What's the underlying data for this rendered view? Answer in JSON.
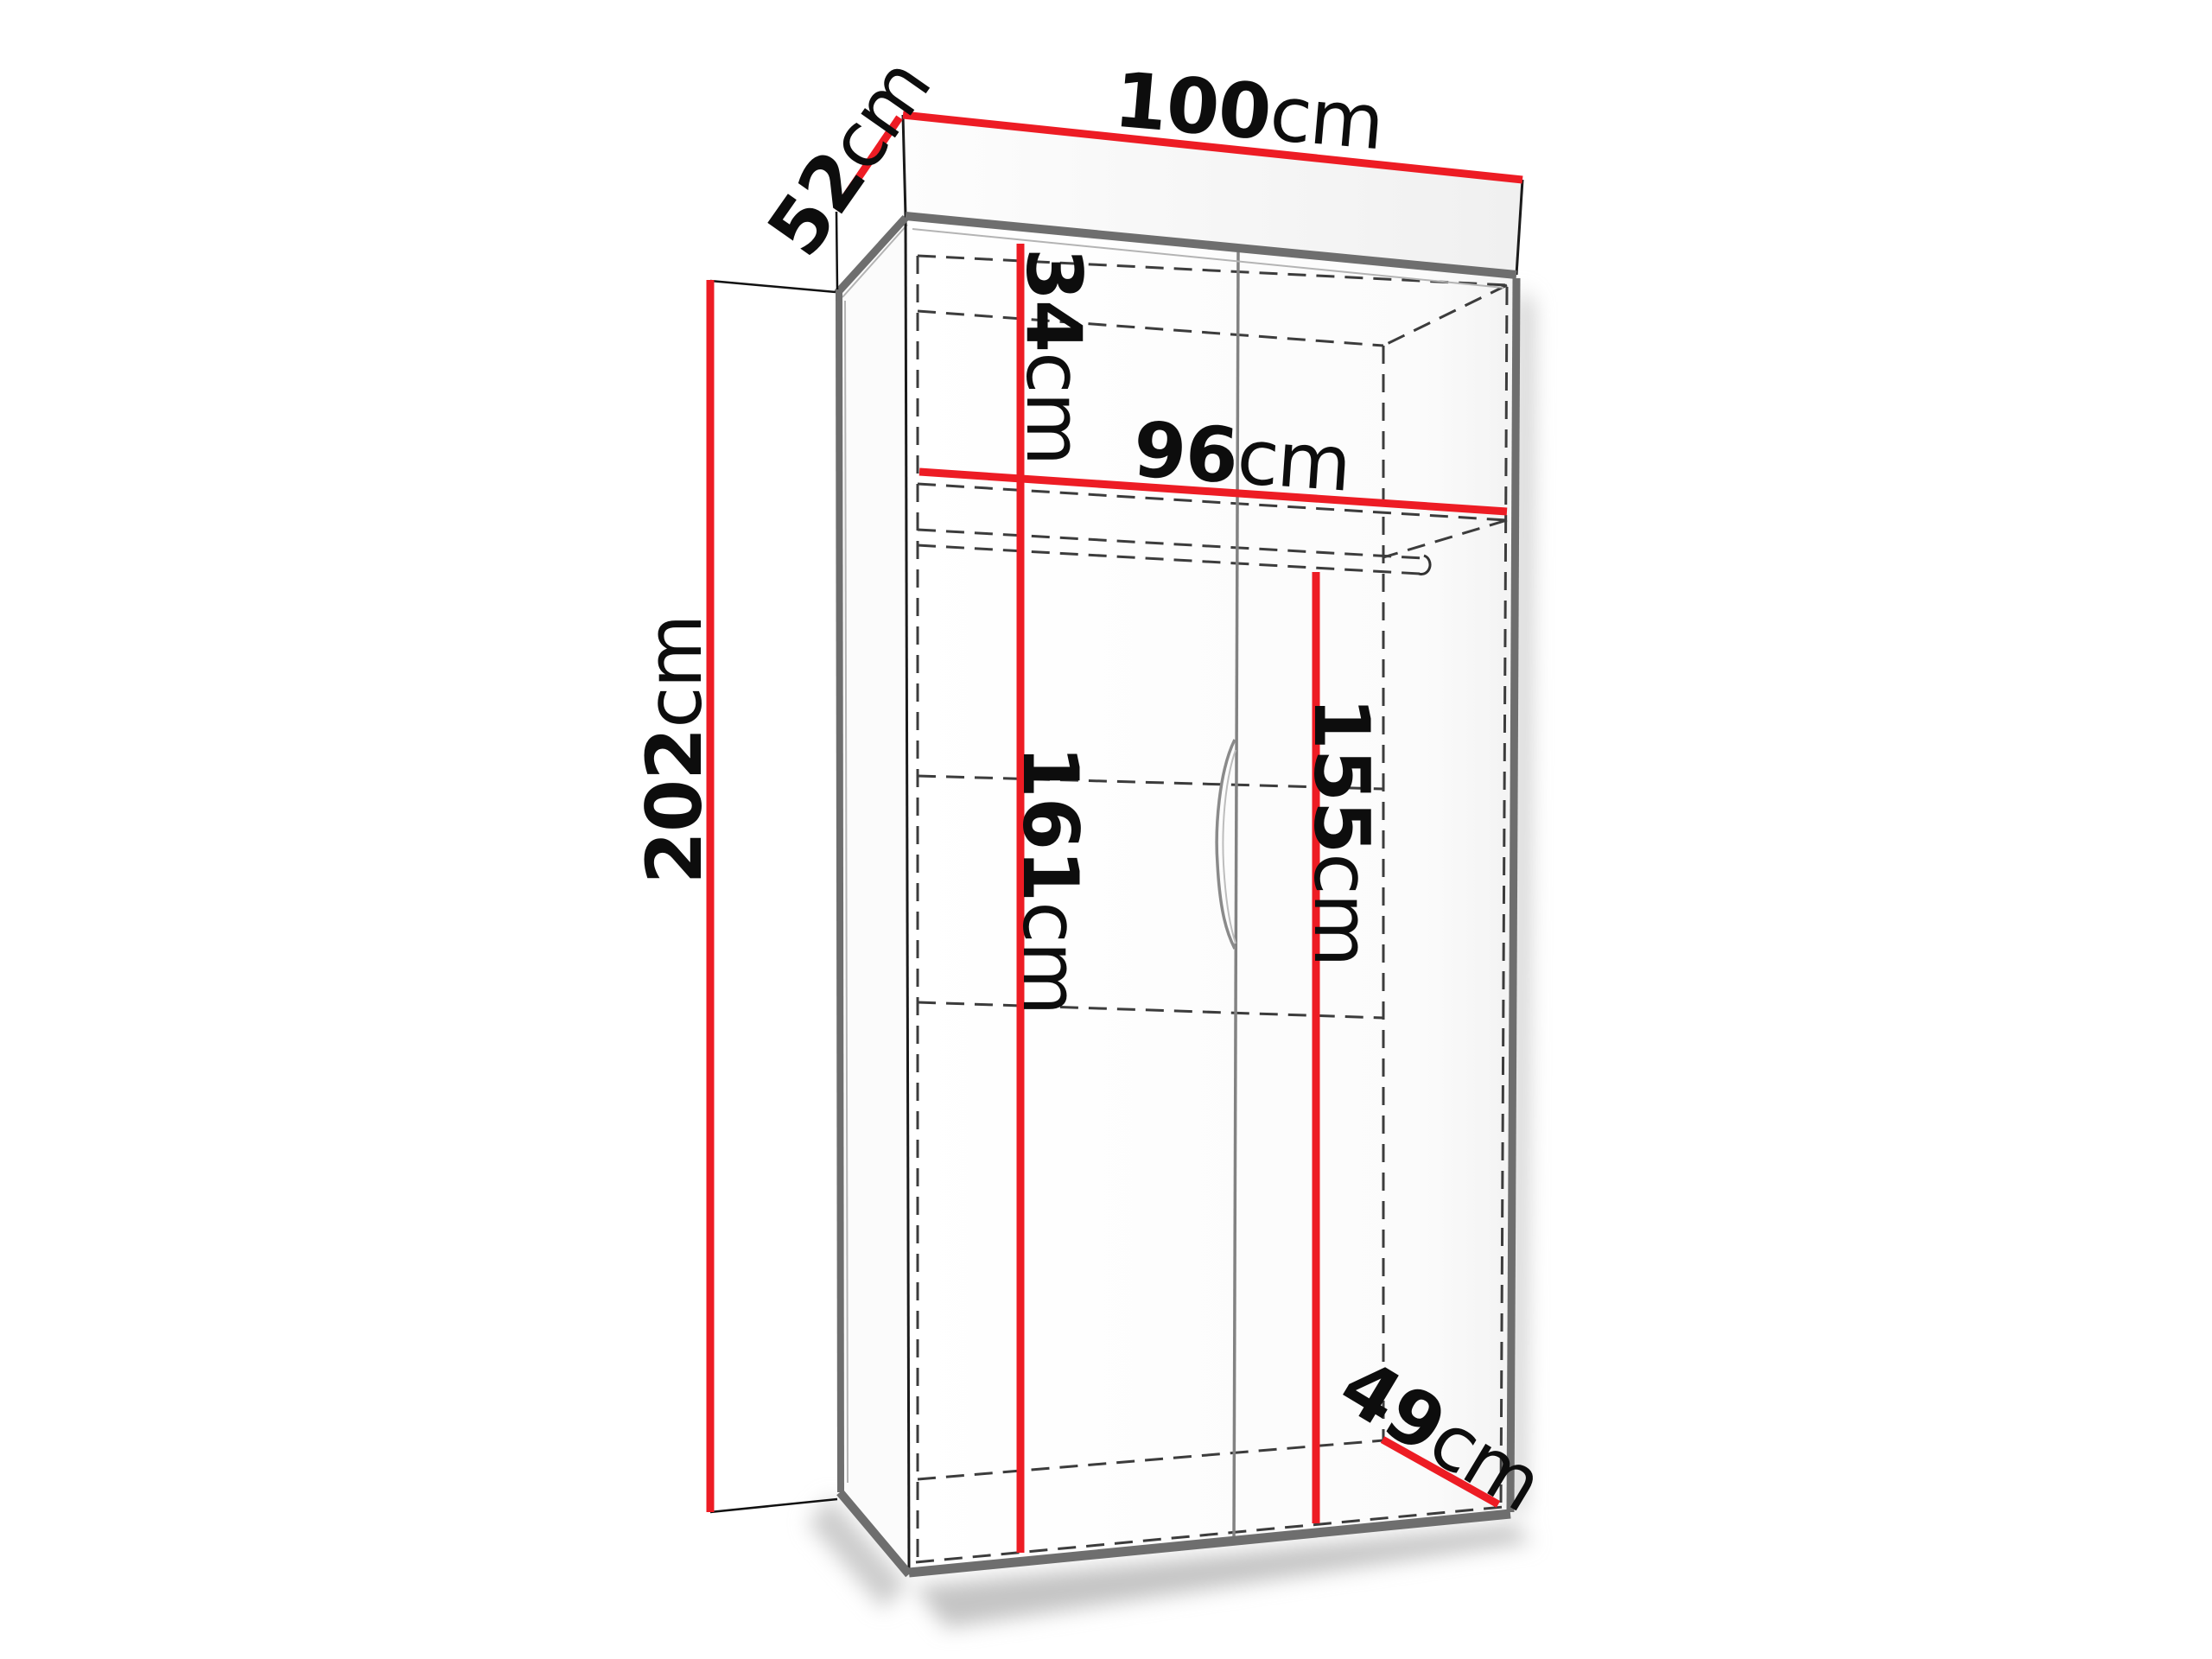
{
  "diagram": {
    "type": "wardrobe-dimension-diagram",
    "unit": "cm",
    "accent_color": "#ed1c24",
    "edge_color": "#6e6e6e",
    "dash_color": "#3c3c3c",
    "text_color": "#0d0d0d",
    "dimensions": {
      "width_top": {
        "value": "100",
        "unit": "cm",
        "measures": "overall width (top back edge)"
      },
      "depth_top": {
        "value": "52",
        "unit": "cm",
        "measures": "overall depth (top left edge)"
      },
      "height_left": {
        "value": "202",
        "unit": "cm",
        "measures": "overall height (left side)"
      },
      "top_section_height": {
        "value": "34",
        "unit": "cm",
        "measures": "upper shelf section height"
      },
      "interior_width": {
        "value": "96",
        "unit": "cm",
        "measures": "interior width at shelf"
      },
      "interior_height_left": {
        "value": "161",
        "unit": "cm",
        "measures": "interior height below shelf (left)"
      },
      "interior_height_right": {
        "value": "155",
        "unit": "cm",
        "measures": "hanging space height below rod (right)"
      },
      "depth_bottom": {
        "value": "49",
        "unit": "cm",
        "measures": "interior depth at bottom"
      }
    }
  }
}
